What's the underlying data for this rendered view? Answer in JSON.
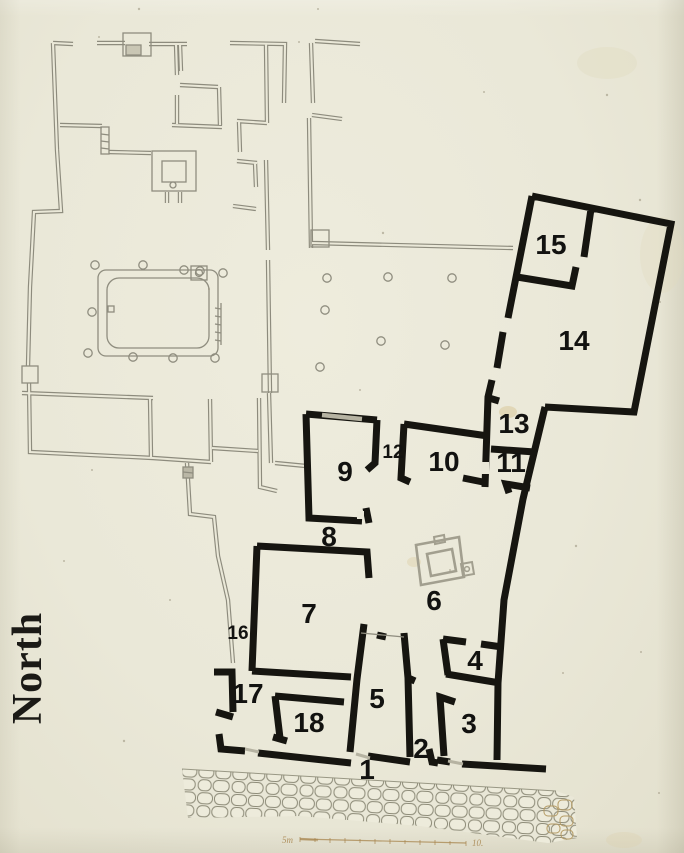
{
  "compass": {
    "label": "North"
  },
  "rooms": [
    {
      "label": "1"
    },
    {
      "label": "2"
    },
    {
      "label": "3"
    },
    {
      "label": "4"
    },
    {
      "label": "5"
    },
    {
      "label": "6"
    },
    {
      "label": "7"
    },
    {
      "label": "8"
    },
    {
      "label": "9"
    },
    {
      "label": "10"
    },
    {
      "label": "11"
    },
    {
      "label": "12"
    },
    {
      "label": "13"
    },
    {
      "label": "14"
    },
    {
      "label": "15"
    },
    {
      "label": "16"
    },
    {
      "label": "17"
    },
    {
      "label": "18"
    }
  ],
  "scale_bar": {
    "left_label": "5m",
    "right_label": "10."
  },
  "colors": {
    "paper": "#eae8d8",
    "ink": "#161510",
    "faint_line": "#8d8b7d",
    "threshold_gray": "#b6b3a2",
    "scale_tan": "#a8854e"
  }
}
